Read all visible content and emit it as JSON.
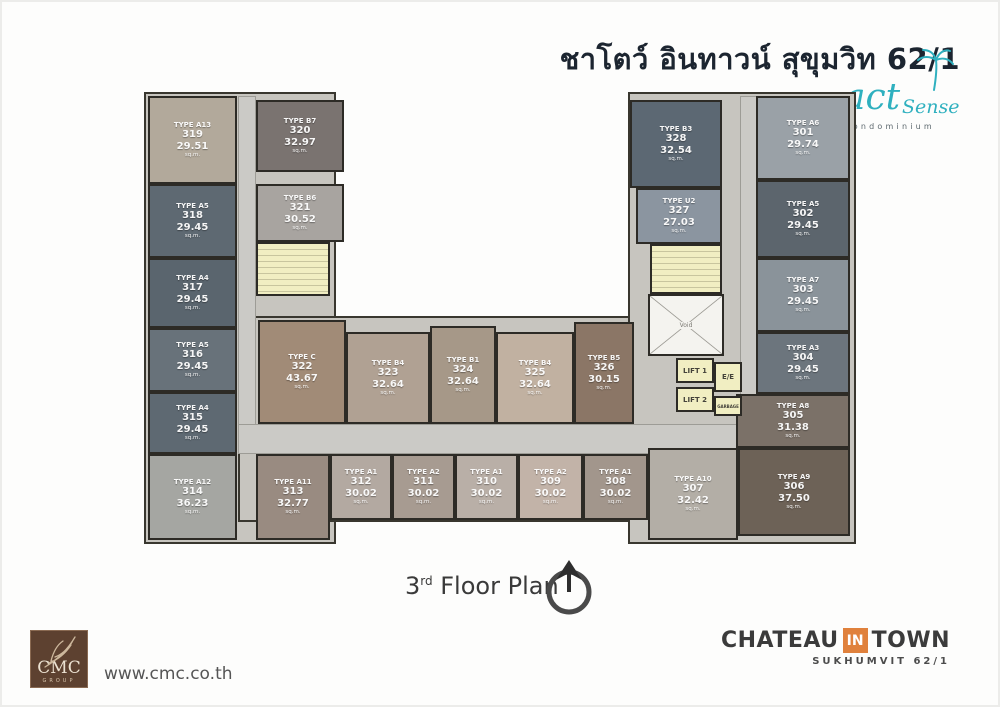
{
  "header": {
    "title": "ชาโตว์ อินทาวน์ สุขุมวิท 62/1",
    "logo": {
      "word1": "act",
      "word2": "Sense",
      "subtitle": "Condominium",
      "color": "#2fb0bf"
    }
  },
  "floor_label": {
    "number": "3",
    "ordinal": "rd",
    "text": " Floor Plan"
  },
  "units": [
    {
      "number": "301",
      "type": "TYPE A6",
      "area": "29.74",
      "unit": "sq.m."
    },
    {
      "number": "302",
      "type": "TYPE A5",
      "area": "29.45",
      "unit": "sq.m."
    },
    {
      "number": "303",
      "type": "TYPE A7",
      "area": "29.45",
      "unit": "sq.m."
    },
    {
      "number": "304",
      "type": "TYPE A3",
      "area": "29.45",
      "unit": "sq.m."
    },
    {
      "number": "305",
      "type": "TYPE A8",
      "area": "31.38",
      "unit": "sq.m."
    },
    {
      "number": "306",
      "type": "TYPE A9",
      "area": "37.50",
      "unit": "sq.m."
    },
    {
      "number": "307",
      "type": "TYPE A10",
      "area": "32.42",
      "unit": "sq.m."
    },
    {
      "number": "308",
      "type": "TYPE A1",
      "area": "30.02",
      "unit": "sq.m."
    },
    {
      "number": "309",
      "type": "TYPE A2",
      "area": "30.02",
      "unit": "sq.m."
    },
    {
      "number": "310",
      "type": "TYPE A1",
      "area": "30.02",
      "unit": "sq.m."
    },
    {
      "number": "311",
      "type": "TYPE A2",
      "area": "30.02",
      "unit": "sq.m."
    },
    {
      "number": "312",
      "type": "TYPE A1",
      "area": "30.02",
      "unit": "sq.m."
    },
    {
      "number": "313",
      "type": "TYPE A11",
      "area": "32.77",
      "unit": "sq.m."
    },
    {
      "number": "314",
      "type": "TYPE A12",
      "area": "36.23",
      "unit": "sq.m."
    },
    {
      "number": "315",
      "type": "TYPE A4",
      "area": "29.45",
      "unit": "sq.m."
    },
    {
      "number": "316",
      "type": "TYPE A5",
      "area": "29.45",
      "unit": "sq.m."
    },
    {
      "number": "317",
      "type": "TYPE A4",
      "area": "29.45",
      "unit": "sq.m."
    },
    {
      "number": "318",
      "type": "TYPE A5",
      "area": "29.45",
      "unit": "sq.m."
    },
    {
      "number": "319",
      "type": "TYPE A13",
      "area": "29.51",
      "unit": "sq.m."
    },
    {
      "number": "320",
      "type": "TYPE B7",
      "area": "32.97",
      "unit": "sq.m."
    },
    {
      "number": "321",
      "type": "TYPE B6",
      "area": "30.52",
      "unit": "sq.m."
    },
    {
      "number": "322",
      "type": "TYPE C",
      "area": "43.67",
      "unit": "sq.m."
    },
    {
      "number": "323",
      "type": "TYPE B4",
      "area": "32.64",
      "unit": "sq.m."
    },
    {
      "number": "324",
      "type": "TYPE B1",
      "area": "32.64",
      "unit": "sq.m."
    },
    {
      "number": "325",
      "type": "TYPE B4",
      "area": "32.64",
      "unit": "sq.m."
    },
    {
      "number": "326",
      "type": "TYPE B5",
      "area": "30.15",
      "unit": "sq.m."
    },
    {
      "number": "327",
      "type": "TYPE U2",
      "area": "27.03",
      "unit": "sq.m."
    },
    {
      "number": "328",
      "type": "TYPE B3",
      "area": "32.54",
      "unit": "sq.m."
    }
  ],
  "service": {
    "lift1": "LIFT 1",
    "lift2": "LIFT 2",
    "ee": "E/E",
    "void": "Void",
    "garbage": "GARBAGE"
  },
  "footer": {
    "cmc_word": "CMC",
    "cmc_group": "GROUP",
    "website": "www.cmc.co.th",
    "brand": {
      "chateau": "CHATEAU",
      "in": "IN",
      "town": "TOWN",
      "subtitle": "SUKHUMVIT 62/1",
      "accent": "#e0813c"
    }
  }
}
